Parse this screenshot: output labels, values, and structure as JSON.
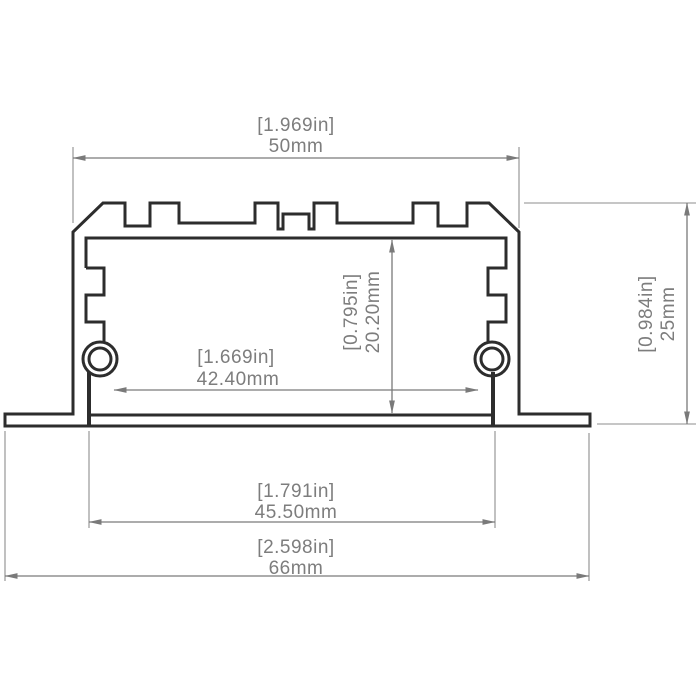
{
  "drawing": {
    "type": "technical-cross-section",
    "subject": "recessed aluminum LED profile extrusion",
    "colors": {
      "background": "#ffffff",
      "outline": "#2d2d2d",
      "dimension_lines": "#7a7a7a",
      "text": "#7d7d7d"
    },
    "dimensions": {
      "overall_width": {
        "inches": "[1.969in]",
        "mm": "50mm"
      },
      "overall_height": {
        "inches": "[0.984in]",
        "mm": "25mm"
      },
      "inner_depth": {
        "inches": "[0.795in]",
        "mm": "20.20mm"
      },
      "inner_width": {
        "inches": "[1.669in]",
        "mm": "42.40mm"
      },
      "recess_width": {
        "inches": "[1.791in]",
        "mm": "45.50mm"
      },
      "flange_width": {
        "inches": "[2.598in]",
        "mm": "66mm"
      }
    }
  }
}
